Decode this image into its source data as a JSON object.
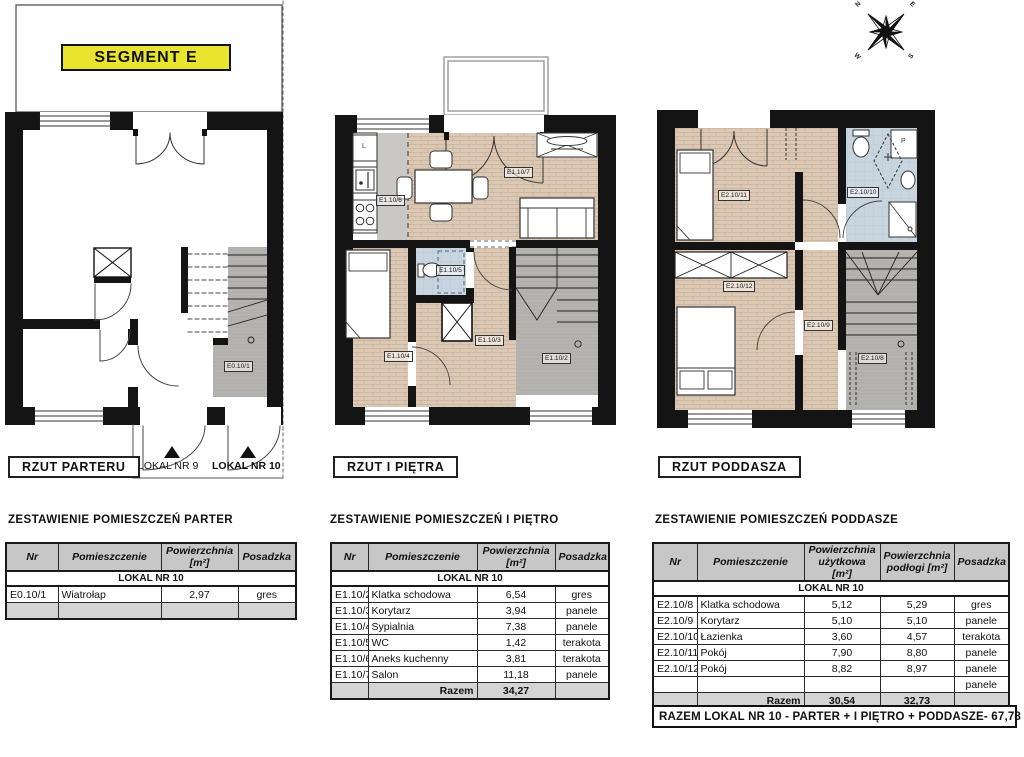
{
  "segment": {
    "label": "SEGMENT E"
  },
  "compass": {
    "n": "N",
    "e": "E",
    "s": "S",
    "w": "W"
  },
  "plans": {
    "parter": {
      "title": "RZUT PARTERU",
      "labels": {
        "wiatrolap": "E0.10/1",
        "lokal9": "LOKAL NR 9",
        "lokal10": "LOKAL NR 10"
      }
    },
    "pietro": {
      "title": "RZUT I PIĘTRA",
      "labels": {
        "klatka": "E1.10/2",
        "korytarz": "E1.10/3",
        "sypialnia": "E1.10/4",
        "wc": "E1.10/5",
        "aneks": "E1.10/6",
        "salon": "E1.10/7",
        "lodowka": "L"
      }
    },
    "poddasze": {
      "title": "RZUT PODDASZA",
      "labels": {
        "klatka": "E2.10/8",
        "korytarz": "E2.10/9",
        "lazienka": "E2.10/10",
        "pokoj1": "E2.10/11",
        "pokoj2": "E2.10/12",
        "pralka": "P"
      }
    }
  },
  "tables": {
    "parter": {
      "title": "ZESTAWIENIE POMIESZCZEŃ PARTER",
      "headers": {
        "nr": "Nr",
        "room": "Pomieszczenie",
        "area": "Powierzchnia [m²]",
        "floor": "Posadzka"
      },
      "group": "LOKAL NR 10",
      "rows": [
        {
          "nr": "E0.10/1",
          "room": "Wiatrołap",
          "area": "2,97",
          "floor": "gres"
        }
      ]
    },
    "pietro": {
      "title": "ZESTAWIENIE POMIESZCZEŃ I PIĘTRO",
      "headers": {
        "nr": "Nr",
        "room": "Pomieszczenie",
        "area": "Powierzchnia [m²]",
        "floor": "Posadzka"
      },
      "group": "LOKAL NR 10",
      "rows": [
        {
          "nr": "E1.10/2",
          "room": "Klatka schodowa",
          "area": "6,54",
          "floor": "gres"
        },
        {
          "nr": "E1.10/3",
          "room": "Korytarz",
          "area": "3,94",
          "floor": "panele"
        },
        {
          "nr": "E1.10/4",
          "room": "Sypialnia",
          "area": "7,38",
          "floor": "panele"
        },
        {
          "nr": "E1.10/5",
          "room": "WC",
          "area": "1,42",
          "floor": "terakota"
        },
        {
          "nr": "E1.10/6",
          "room": "Aneks kuchenny",
          "area": "3,81",
          "floor": "terakota"
        },
        {
          "nr": "E1.10/7",
          "room": "Salon",
          "area": "11,18",
          "floor": "panele"
        }
      ],
      "total_label": "Razem",
      "total_area": "34,27"
    },
    "poddasze": {
      "title": "ZESTAWIENIE POMIESZCZEŃ PODDASZE",
      "headers": {
        "nr": "Nr",
        "room": "Pomieszczenie",
        "area_usable": "Powierzchnia użytkowa [m²]",
        "area_floor": "Powierzchnia podłogi [m²]",
        "floor": "Posadzka"
      },
      "group": "LOKAL NR 10",
      "rows": [
        {
          "nr": "E2.10/8",
          "room": "Klatka schodowa",
          "usable": "5,12",
          "floor_area": "5,29",
          "floor": "gres"
        },
        {
          "nr": "E2.10/9",
          "room": "Korytarz",
          "usable": "5,10",
          "floor_area": "5,10",
          "floor": "panele"
        },
        {
          "nr": "E2.10/10",
          "room": "Łazienka",
          "usable": "3,60",
          "floor_area": "4,57",
          "floor": "terakota"
        },
        {
          "nr": "E2.10/11",
          "room": "Pokój",
          "usable": "7,90",
          "floor_area": "8,80",
          "floor": "panele"
        },
        {
          "nr": "E2.10/12",
          "room": "Pokój",
          "usable": "8,82",
          "floor_area": "8,97",
          "floor": "panele"
        }
      ],
      "extra_row_floor": "panele",
      "total_label": "Razem",
      "total_usable": "30,54",
      "total_floor": "32,73"
    }
  },
  "summary": "RAZEM LOKAL NR 10 - PARTER + I PIĘTRO + PODDASZE- 67,78 m²"
}
